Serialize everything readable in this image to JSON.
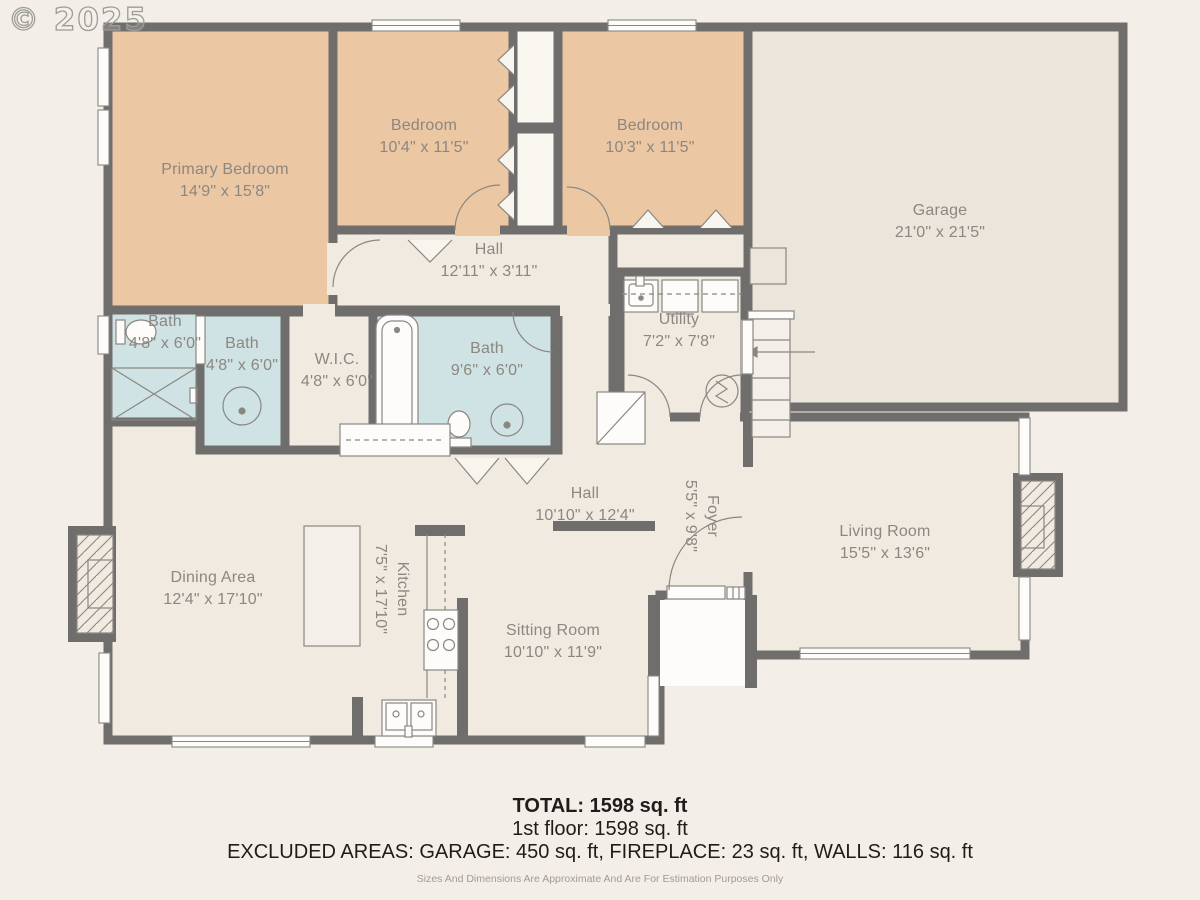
{
  "watermark": "© 2025",
  "rooms": {
    "primary_bedroom": {
      "name": "Primary Bedroom",
      "dims": "14'9\" x 15'8\""
    },
    "bedroom_1": {
      "name": "Bedroom",
      "dims": "10'4\" x 11'5\""
    },
    "bedroom_2": {
      "name": "Bedroom",
      "dims": "10'3\" x 11'5\""
    },
    "garage": {
      "name": "Garage",
      "dims": "21'0\" x 21'5\""
    },
    "hall_upper": {
      "name": "Hall",
      "dims": "12'11\" x 3'11\""
    },
    "utility": {
      "name": "Utility",
      "dims": "7'2\" x 7'8\""
    },
    "bath_1": {
      "name": "Bath",
      "dims": "4'8\" x 6'0\""
    },
    "bath_2": {
      "name": "Bath",
      "dims": "4'8\" x 6'0\""
    },
    "wic": {
      "name": "W.I.C.",
      "dims": "4'8\" x 6'0\""
    },
    "bath_3": {
      "name": "Bath",
      "dims": "9'6\" x 6'0\""
    },
    "hall_lower": {
      "name": "Hall",
      "dims": "10'10\" x 12'4\""
    },
    "foyer": {
      "name": "Foyer",
      "dims": "5'5\" x 9'8\""
    },
    "living_room": {
      "name": "Living Room",
      "dims": "15'5\" x 13'6\""
    },
    "dining_area": {
      "name": "Dining Area",
      "dims": "12'4\" x 17'10\""
    },
    "kitchen": {
      "name": "Kitchen",
      "dims": "7'5\" x 17'10\""
    },
    "sitting_room": {
      "name": "Sitting Room",
      "dims": "10'10\" x 11'9\""
    }
  },
  "footer": {
    "total": "TOTAL: 1598 sq. ft",
    "floor": "1st floor: 1598 sq. ft",
    "excluded": "EXCLUDED AREAS: GARAGE: 450 sq. ft, FIREPLACE: 23 sq. ft, WALLS: 116 sq. ft",
    "disclaimer": "Sizes And Dimensions Are Approximate And Are For Estimation Purposes Only"
  },
  "colors": {
    "wall": "#6f6e6c",
    "bedroom_fill": "#ebc7a3",
    "bath_fill": "#cfe2e4",
    "room_fill": "#f1eae1",
    "garage_fill": "#ece5db",
    "closet_fill": "#faf7f1",
    "white_fixture": "#fdfcfa",
    "label_text": "#8c8781"
  }
}
